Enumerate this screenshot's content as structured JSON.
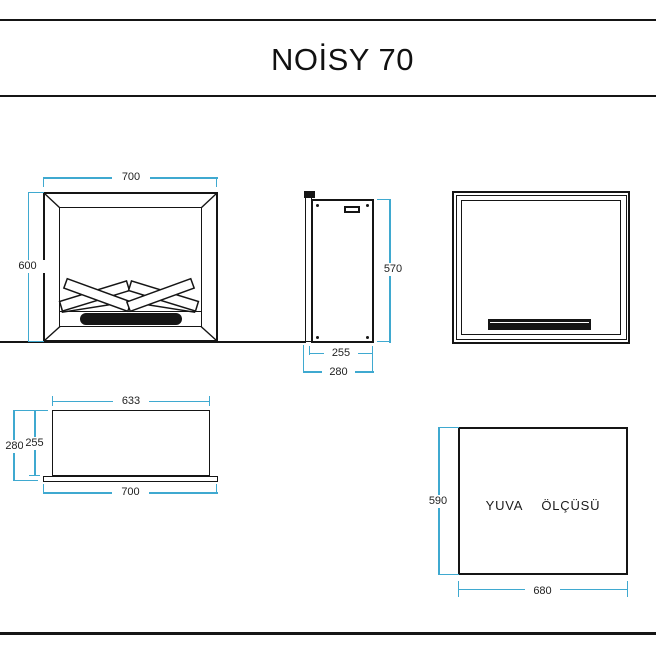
{
  "title": "NOİSY 70",
  "colors": {
    "accent": "#3fa9d0",
    "ink": "#151515",
    "dim_text": "#222222"
  },
  "views": {
    "front": {
      "width": "700",
      "height": "600"
    },
    "side": {
      "height": "570",
      "body_depth": "255",
      "total_depth": "280"
    },
    "top": {
      "body_width": "633",
      "total_width": "700",
      "total_depth": "280",
      "body_depth": "255"
    },
    "niche": {
      "caption": "YUVA  ÖLÇÜSÜ",
      "height": "590",
      "width": "680"
    }
  }
}
